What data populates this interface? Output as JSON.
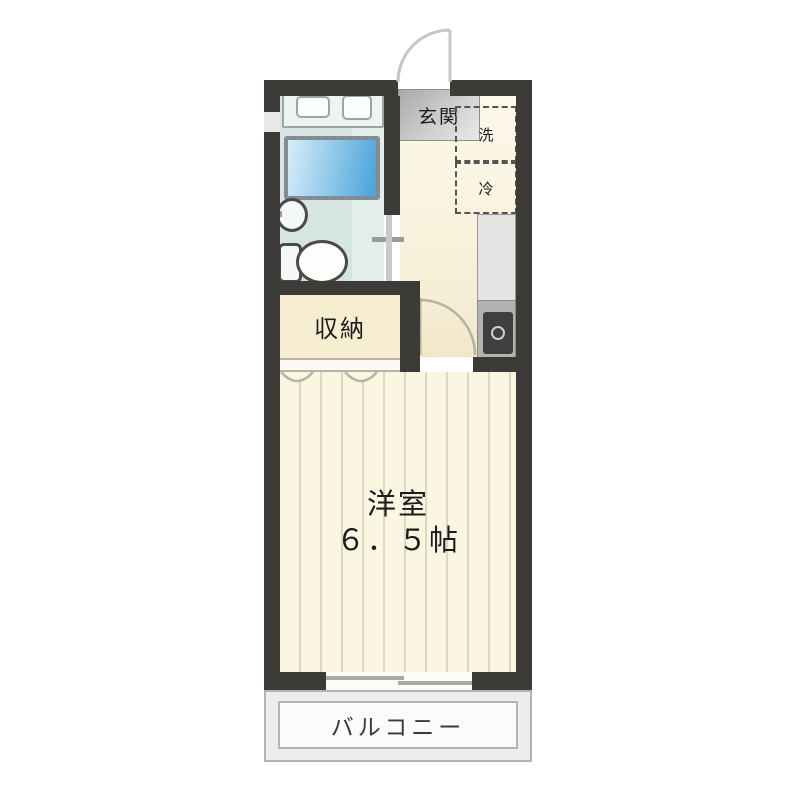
{
  "floorplan": {
    "type": "apartment-floor-plan",
    "rooms": {
      "entrance": {
        "label": "玄関"
      },
      "washer_space": {
        "label": "洗"
      },
      "fridge_space": {
        "label": "冷"
      },
      "closet": {
        "label": "収納"
      },
      "main_room": {
        "name": "洋室",
        "size": "６．５帖"
      },
      "balcony": {
        "label": "バルコニー"
      }
    },
    "colors": {
      "wall": "#3c3b38",
      "room_floor": "#fbf6e2",
      "room_stripe": "#dcd8c6",
      "closet_floor": "#f7eed2",
      "bathroom_floor": "#d7e5e2",
      "bathtub_start": "#d8eef8",
      "bathtub_end": "#4fa6dc",
      "stove": "#3f3f3f",
      "balcony_floor": "#ededed"
    }
  }
}
